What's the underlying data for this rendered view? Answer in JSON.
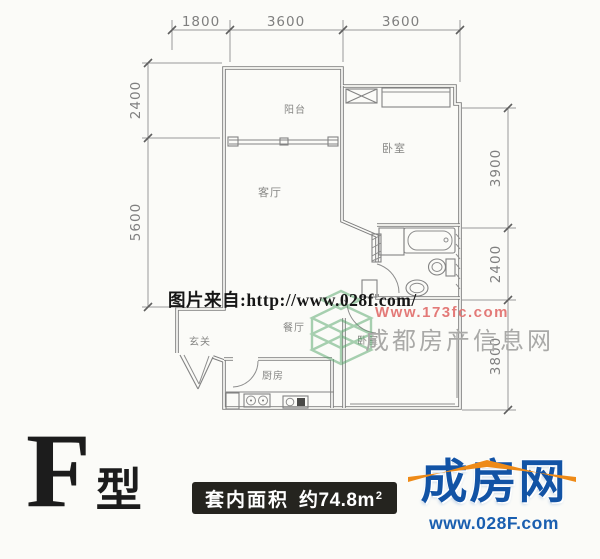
{
  "colors": {
    "plan_line": "#7e7e7e",
    "dim_text": "#7f7f7f",
    "watermark_black": "#161616",
    "watermark_red": "#e2706e",
    "watermark_gray": "#a9a9a7",
    "watermark_green": "#53a468",
    "area_box_bg": "#25241f",
    "area_box_fg": "#ffffff",
    "logo_blue": "#1253a5",
    "logo_orange": "#ee8a17"
  },
  "plan": {
    "rooms": [
      {
        "id": "balcony",
        "label": "阳台"
      },
      {
        "id": "living",
        "label": "客厅"
      },
      {
        "id": "bedroom-top",
        "label": "卧室"
      },
      {
        "id": "bedroom-bottom",
        "label": "卧室"
      },
      {
        "id": "dining",
        "label": "餐厅"
      },
      {
        "id": "kitchen",
        "label": "厨房"
      },
      {
        "id": "entry",
        "label": "玄关"
      }
    ],
    "dims_top": [
      "1800",
      "3600",
      "3600"
    ],
    "dims_left": [
      "2400",
      "5600"
    ],
    "dims_right": [
      "3900",
      "2400",
      "3800"
    ]
  },
  "watermarks": {
    "source": "图片来自:http://www.028f.com/",
    "site_url": "Www.173fc.com",
    "site_name": "成都房产信息网"
  },
  "footer": {
    "type_letter": "F",
    "type_suffix": "型",
    "area_label": "套内面积",
    "area_value": "约74.8m",
    "area_sup": "2",
    "logo_name": "成房网",
    "logo_url": "www.028F.com"
  }
}
